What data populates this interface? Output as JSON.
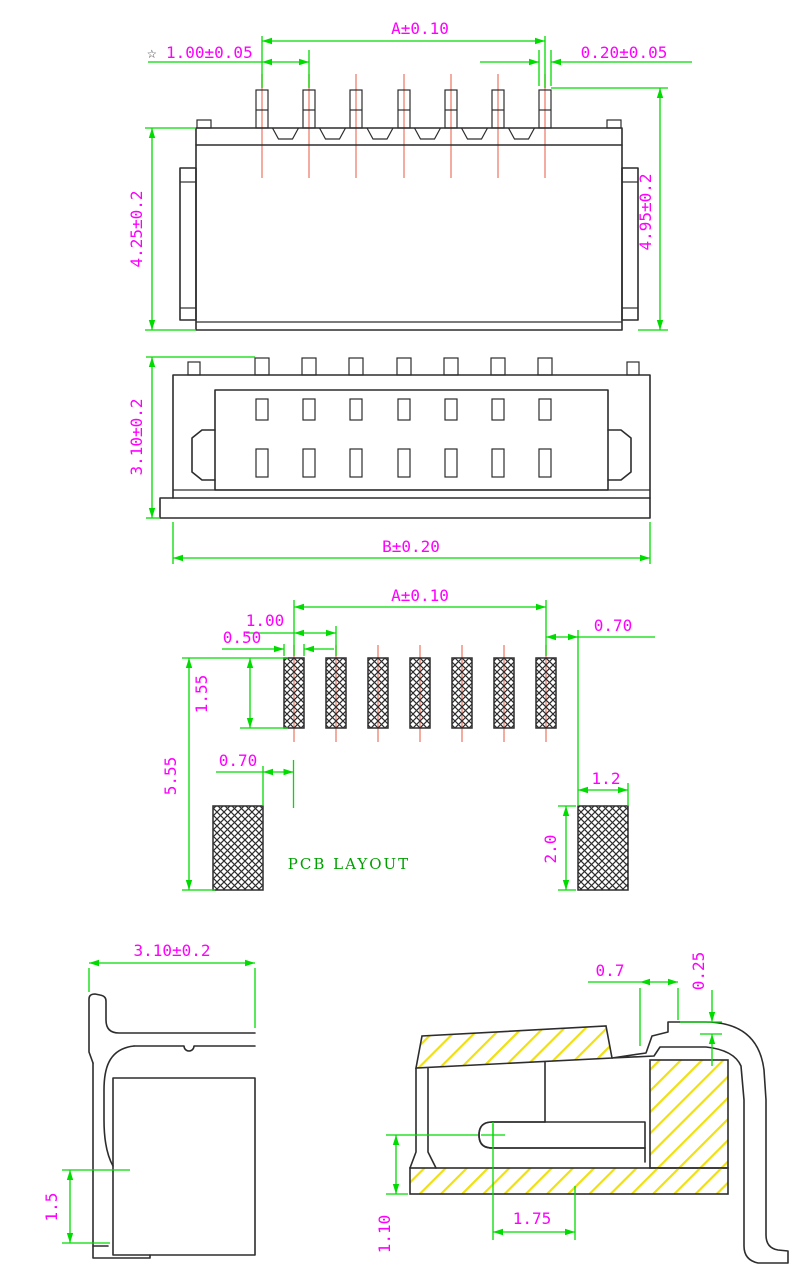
{
  "colors": {
    "dimension_green": "#00dc00",
    "dim_text_magenta": "#ff00ff",
    "outline_dark": "#2d2d2d",
    "centerline_red": "#f08878",
    "hatch_yellow": "#f0e010",
    "caption_green": "#00a000"
  },
  "top_view": {
    "pin_count": 7,
    "dim_pin_span": "A±0.10",
    "pitch_star": "☆",
    "dim_pitch": "1.00±0.05",
    "dim_pin_width": "0.20±0.05",
    "dim_body_height": "4.25±0.2",
    "dim_total_height": "4.95±0.2"
  },
  "front_view": {
    "dim_body_depth": "3.10±0.2",
    "dim_body_width": "B±0.20"
  },
  "pcb_layout": {
    "caption": "PCB LAYOUT",
    "pad_count": 7,
    "dim_pad_span": "A±0.10",
    "dim_pad_pitch": "1.00",
    "dim_pad_width": "0.50",
    "dim_pad_length": "1.55",
    "dim_anchor_offset": "0.70",
    "dim_overall_length": "5.55",
    "dim_pad_to_anchor": "0.70",
    "dim_anchor_pad_width": "1.2",
    "dim_anchor_pad_height": "2.0"
  },
  "side_view": {
    "dim_width": "3.10±0.2",
    "dim_foot_height": "1.5"
  },
  "section_view": {
    "dim_lead_top": "0.7",
    "dim_lead_thickness": "0.25",
    "dim_contact_depth": "1.75",
    "dim_standoff": "1.10"
  }
}
